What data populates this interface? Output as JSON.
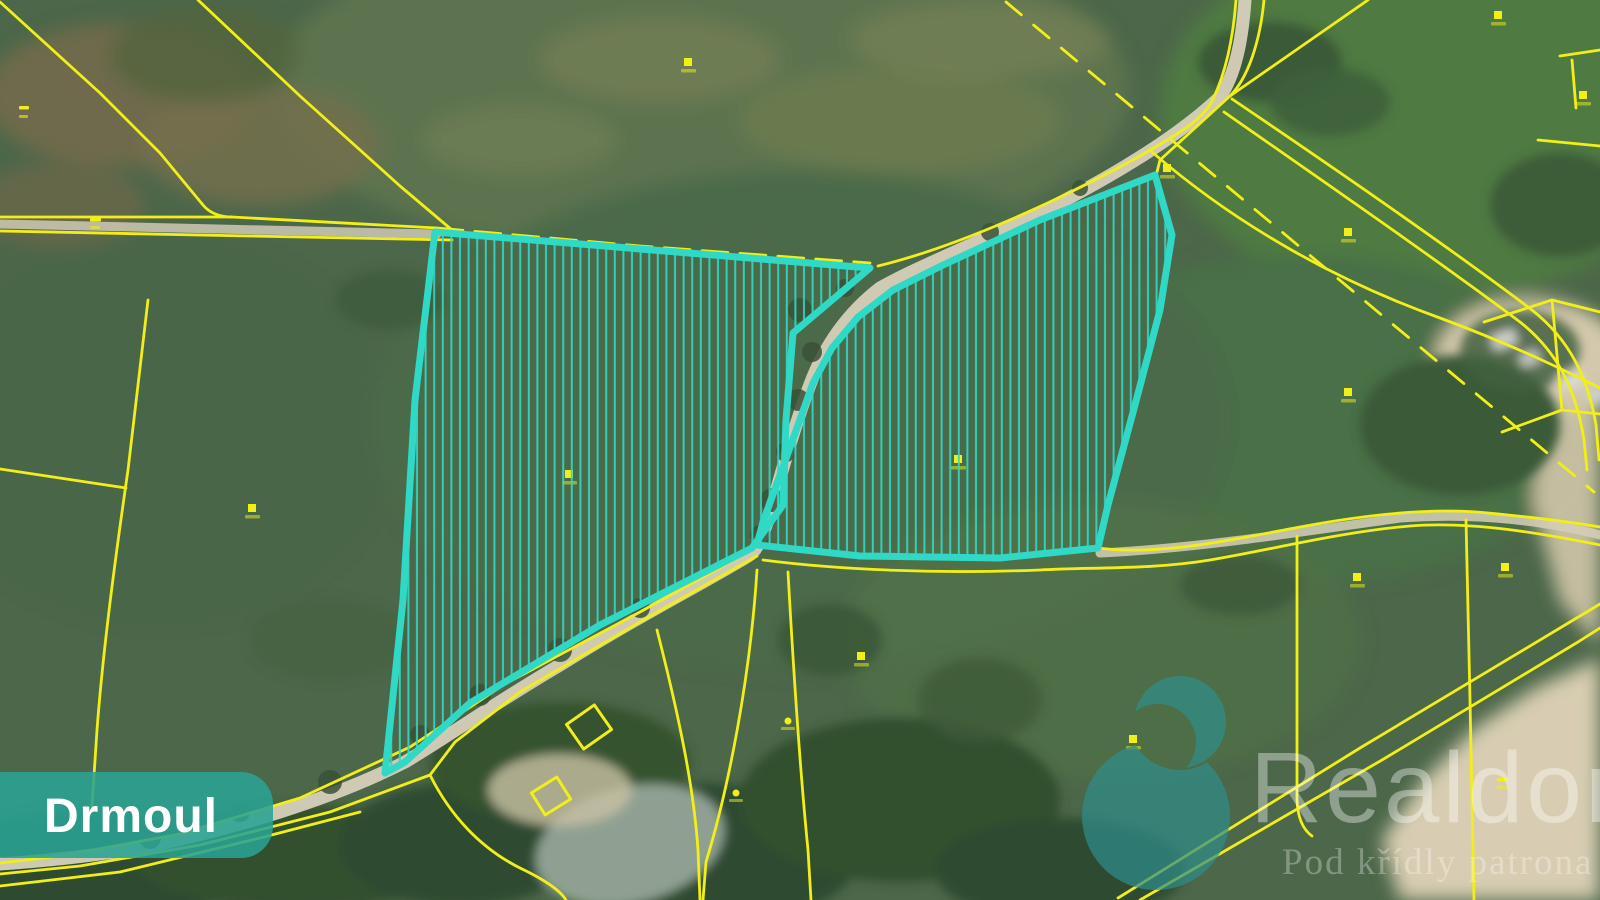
{
  "map": {
    "municipality_label": "Drmoul",
    "watermark": {
      "brand": "Realdomus",
      "tagline": "Pod křídly patrona realit"
    },
    "colors": {
      "parcel_highlight": "#2fd9c6",
      "cadastral_line": "#f1ef17",
      "label_bg": "#2aa394",
      "label_text": "#ffffff",
      "logo_teal": "#2f8e8c",
      "watermark_text": "#ffffff"
    },
    "highlighted_parcels": [
      {
        "id": "west-parcel",
        "hatch": "vertical"
      },
      {
        "id": "east-parcel",
        "hatch": "vertical"
      }
    ],
    "markers": [
      {
        "x": 24,
        "y": 108,
        "kind": "dash2"
      },
      {
        "x": 95,
        "y": 220,
        "kind": "dash"
      },
      {
        "x": 688,
        "y": 62,
        "kind": "sq"
      },
      {
        "x": 252,
        "y": 508,
        "kind": "sq"
      },
      {
        "x": 569,
        "y": 474,
        "kind": "sq"
      },
      {
        "x": 958,
        "y": 459,
        "kind": "sq"
      },
      {
        "x": 1167,
        "y": 168,
        "kind": "sq"
      },
      {
        "x": 1348,
        "y": 232,
        "kind": "sq"
      },
      {
        "x": 1348,
        "y": 392,
        "kind": "sq"
      },
      {
        "x": 861,
        "y": 656,
        "kind": "sq"
      },
      {
        "x": 788,
        "y": 721,
        "kind": "dot"
      },
      {
        "x": 736,
        "y": 793,
        "kind": "dot"
      },
      {
        "x": 1505,
        "y": 567,
        "kind": "sq"
      },
      {
        "x": 1357,
        "y": 577,
        "kind": "sq"
      },
      {
        "x": 1498,
        "y": 15,
        "kind": "sq"
      },
      {
        "x": 1583,
        "y": 95,
        "kind": "sq"
      },
      {
        "x": 1133,
        "y": 739,
        "kind": "sq"
      },
      {
        "x": 1502,
        "y": 780,
        "kind": "dash"
      }
    ]
  }
}
